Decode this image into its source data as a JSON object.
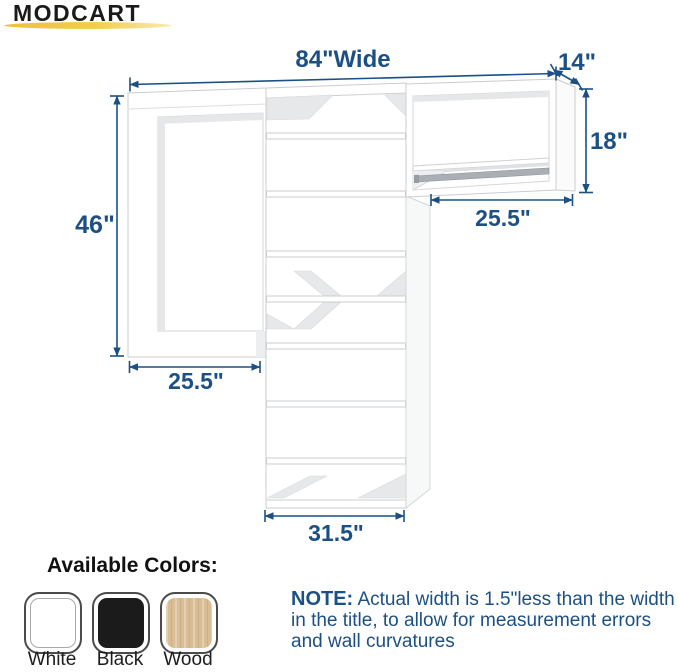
{
  "brand": {
    "name": "MODCART"
  },
  "diagram": {
    "labels": {
      "total_width": "84\"Wide",
      "depth": "14\"",
      "hang_section_height": "18\"",
      "hang_section_width": "25.5\"",
      "left_section_height": "46\"",
      "left_section_width": "25.5\"",
      "tower_width": "31.5\""
    },
    "dimension_color": "#1c5084",
    "rod_color": "#a9afb4"
  },
  "colors_section": {
    "heading": "Available Colors:",
    "swatches": [
      {
        "label": "White",
        "hex": "#ffffff"
      },
      {
        "label": "Black",
        "hex": "#1b1b1b"
      },
      {
        "label": "Wood",
        "hex": "#d8bd95"
      }
    ]
  },
  "note": {
    "label": "NOTE:",
    "lines": [
      "Actual width is 1.5\"less than the width",
      "in the title, to allow for measurement errors",
      "and wall curvatures"
    ]
  },
  "logo_underline_color": "#f0c53c"
}
